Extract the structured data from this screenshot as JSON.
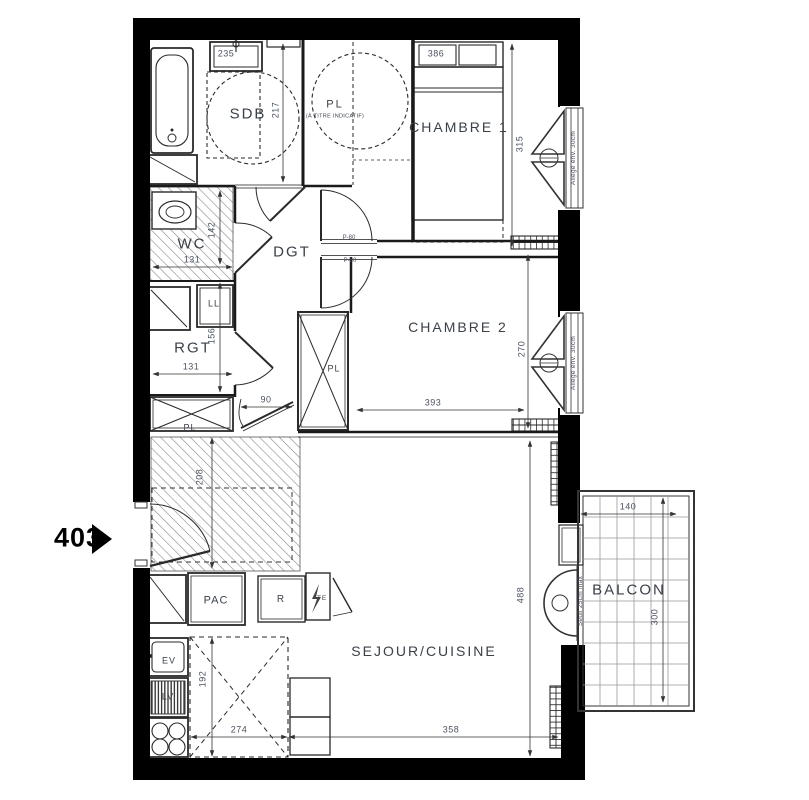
{
  "unit": {
    "number": "403"
  },
  "rooms": {
    "sdb": "SDB",
    "pl": "PL",
    "pl_note": "(À TITRE INDICATIF)",
    "chambre1": "CHAMBRE 1",
    "wc": "WC",
    "dgt": "DGT",
    "chambre2": "CHAMBRE 2",
    "rgt": "RGT",
    "sejour": "SEJOUR/CUISINE",
    "balcon": "BALCON"
  },
  "fixtures": {
    "ll": "LL",
    "pl_mid": "PL",
    "pl_entry": "PL",
    "pac": "PAC",
    "fridge": "R",
    "te": "TE",
    "ev": "EV",
    "lv": "LV"
  },
  "dims": {
    "sink": "235",
    "sdb_depth": "217",
    "bed": "386",
    "ch1_height": "315",
    "wc_width": "131",
    "wc_depth": "142",
    "rgt_depth": "156",
    "rgt_width": "131",
    "door": "90",
    "ch2_width": "393",
    "ch2_height": "270",
    "entry_depth": "208",
    "kitchen_depth": "192",
    "kitchen_width": "274",
    "sejour_width": "358",
    "sejour_height": "488",
    "balcon_width": "140",
    "balcon_depth": "300"
  },
  "annotations": {
    "window1": "Allège env. 30cm",
    "window2": "Allège env. 30cm",
    "threshold": "Seuil 25cm max",
    "door1": "P-80",
    "door2": "P-80"
  }
}
